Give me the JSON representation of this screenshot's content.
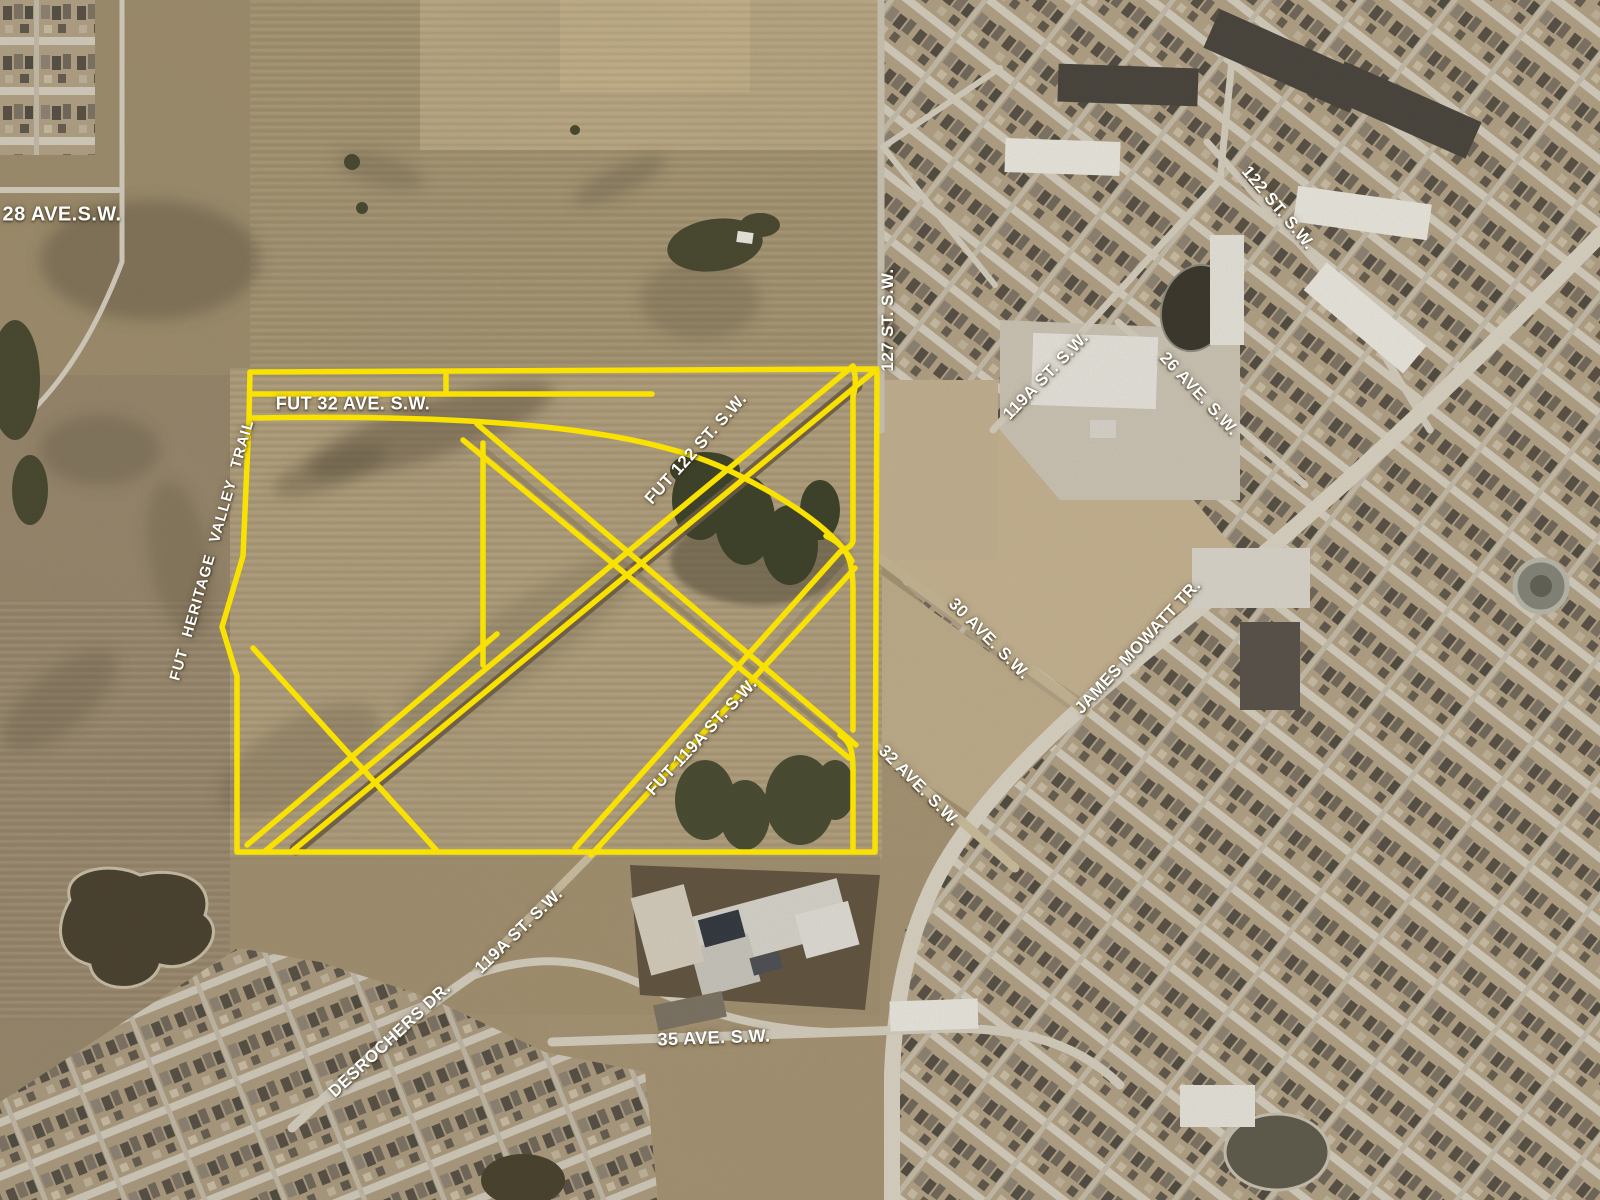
{
  "map": {
    "labels": {
      "ave_28": "28 AVE.S.W.",
      "st_122": "122 ST. S.W.",
      "st_127": "127 ST. S.W.",
      "st_119a_north": "119A ST. S.W.",
      "ave_26": "26 AVE. S.W.",
      "fut_32_ave": "FUT 32 AVE. S.W.",
      "fut_122_st": "FUT 122 ST. S.W.",
      "fut_heritage_valley_trail": "FUT HERITAGE VALLEY TRAIL",
      "ave_30": "30 AVE. S.W.",
      "james_mowatt": "JAMES MOWATT TR.",
      "fut_119a_st": "FUT 119A ST. S.W.",
      "ave_32": "32 AVE. S.W.",
      "st_119a_south": "119A ST. S.W.",
      "desrochers": "DESROCHERS DR.",
      "ave_35": "35 AVE. S.W."
    },
    "colors": {
      "overlay_yellow": "#f9e200",
      "label_text": "#ffffff",
      "farmland": "#a89573",
      "street_grey": "#d6d0c2"
    }
  }
}
